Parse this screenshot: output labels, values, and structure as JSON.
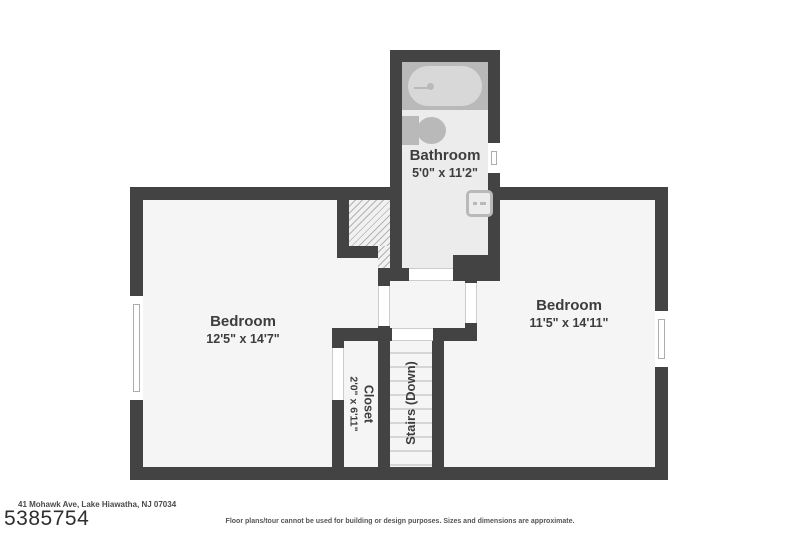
{
  "document": {
    "address": "41 Mohawk Ave, Lake Hiawatha, NJ 07034",
    "listing_number": "5385754",
    "disclaimer": "Floor plans/tour cannot be used for building or design purposes. Sizes and dimensions are approximate."
  },
  "rooms": {
    "bathroom": {
      "name": "Bathroom",
      "dims": "5'0\" x 11'2\""
    },
    "bedroom_left": {
      "name": "Bedroom",
      "dims": "12'5\" x 14'7\""
    },
    "bedroom_right": {
      "name": "Bedroom",
      "dims": "11'5\" x 14'11\""
    },
    "closet": {
      "name": "Closet",
      "dims": "2'0\" x 6'11\""
    },
    "stairs": {
      "name": "Stairs (Down)"
    }
  },
  "colors": {
    "wall": "#434343",
    "floor": "#f5f5f5",
    "bathroom_floor": "#ececec",
    "fixture": "#b9b9b9",
    "label_text": "#3d3d3d"
  }
}
